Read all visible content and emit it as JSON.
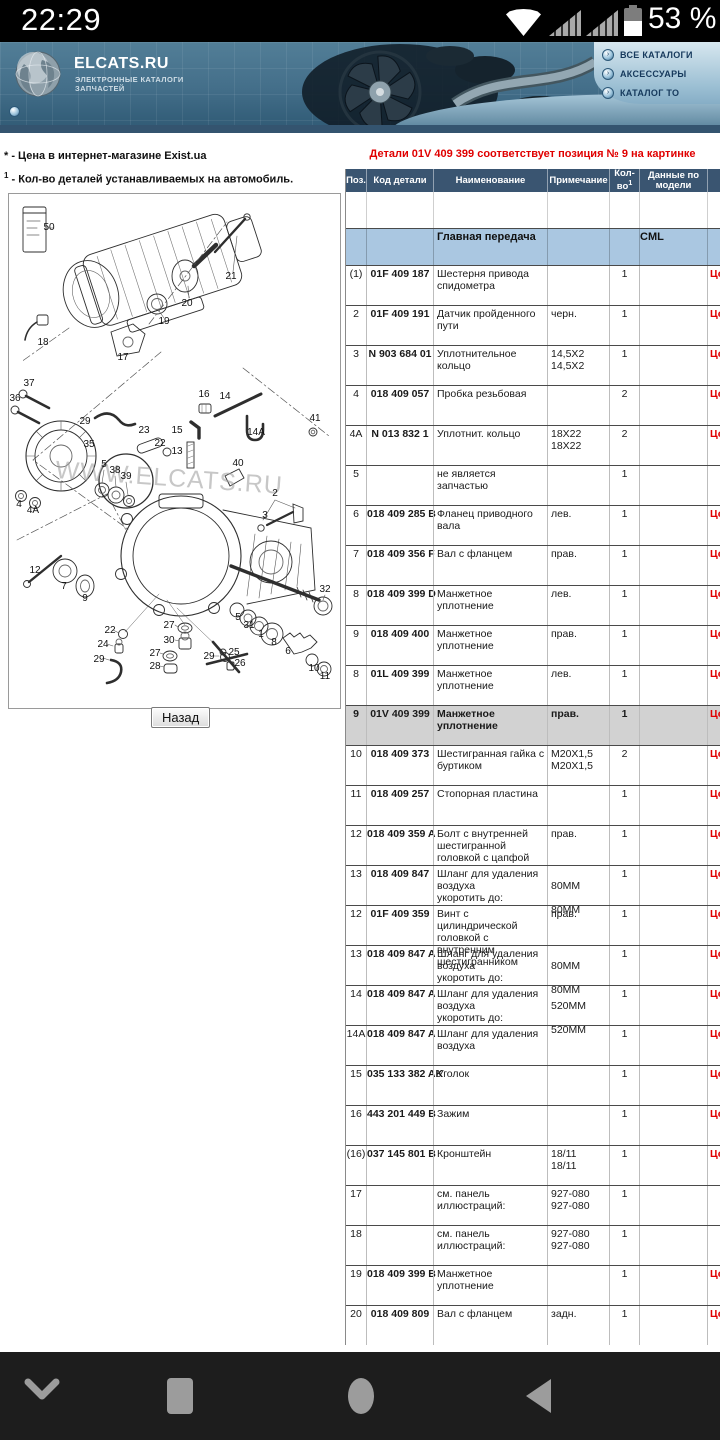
{
  "status_bar": {
    "time": "22:29",
    "battery_pct": "53 %"
  },
  "header": {
    "logo_title": "ELCATS.RU",
    "logo_sub1": "ЭЛЕКТРОННЫЕ КАТАЛОГИ",
    "logo_sub2": "ЗАПЧАСТЕЙ",
    "nav": [
      {
        "label": "ВСЕ КАТАЛОГИ"
      },
      {
        "label": "АКСЕССУАРЫ"
      },
      {
        "label": "КАТАЛОГ ТО"
      }
    ]
  },
  "notes": {
    "price_note": "* - Цена в интернет-магазине Exist.ua",
    "qty_sup": "1",
    "qty_note": " - Кол-во деталей устанавливаемых на автомобиль."
  },
  "alert": "Детали 01V 409 399 соответствует позиция № 9 на картинке",
  "diagram": {
    "back_button": "Назад",
    "watermark": "WWW.ELCATS.RU",
    "callouts": [
      {
        "l": "50",
        "x": 40,
        "y": 36
      },
      {
        "l": "21",
        "x": 222,
        "y": 85
      },
      {
        "l": "20",
        "x": 178,
        "y": 112
      },
      {
        "l": "19",
        "x": 155,
        "y": 130
      },
      {
        "l": "18",
        "x": 34,
        "y": 151
      },
      {
        "l": "17",
        "x": 114,
        "y": 166
      },
      {
        "l": "37",
        "x": 20,
        "y": 192
      },
      {
        "l": "36",
        "x": 6,
        "y": 207
      },
      {
        "l": "29",
        "x": 76,
        "y": 230
      },
      {
        "l": "23",
        "x": 135,
        "y": 239
      },
      {
        "l": "22",
        "x": 151,
        "y": 252
      },
      {
        "l": "16",
        "x": 195,
        "y": 203
      },
      {
        "l": "14",
        "x": 216,
        "y": 205
      },
      {
        "l": "15",
        "x": 168,
        "y": 239
      },
      {
        "l": "13",
        "x": 168,
        "y": 260
      },
      {
        "l": "14A",
        "x": 247,
        "y": 241
      },
      {
        "l": "41",
        "x": 306,
        "y": 227
      },
      {
        "l": "40",
        "x": 229,
        "y": 272
      },
      {
        "l": "2",
        "x": 266,
        "y": 302
      },
      {
        "l": "3",
        "x": 256,
        "y": 324
      },
      {
        "l": "35",
        "x": 80,
        "y": 253
      },
      {
        "l": "5",
        "x": 95,
        "y": 273
      },
      {
        "l": "38",
        "x": 106,
        "y": 279
      },
      {
        "l": "39",
        "x": 117,
        "y": 285
      },
      {
        "l": "4",
        "x": 10,
        "y": 313
      },
      {
        "l": "4A",
        "x": 24,
        "y": 319
      },
      {
        "l": "12",
        "x": 26,
        "y": 379
      },
      {
        "l": "7",
        "x": 55,
        "y": 395
      },
      {
        "l": "9",
        "x": 76,
        "y": 407
      },
      {
        "l": "22",
        "x": 101,
        "y": 439
      },
      {
        "l": "24",
        "x": 94,
        "y": 453
      },
      {
        "l": "29",
        "x": 90,
        "y": 468
      },
      {
        "l": "27",
        "x": 160,
        "y": 434
      },
      {
        "l": "30",
        "x": 160,
        "y": 449
      },
      {
        "l": "27",
        "x": 146,
        "y": 462
      },
      {
        "l": "28",
        "x": 146,
        "y": 475
      },
      {
        "l": "29",
        "x": 200,
        "y": 465
      },
      {
        "l": "25",
        "x": 225,
        "y": 461
      },
      {
        "l": "26",
        "x": 231,
        "y": 472
      },
      {
        "l": "5",
        "x": 229,
        "y": 426
      },
      {
        "l": "31",
        "x": 240,
        "y": 434
      },
      {
        "l": "1",
        "x": 252,
        "y": 443
      },
      {
        "l": "8",
        "x": 265,
        "y": 451
      },
      {
        "l": "6",
        "x": 279,
        "y": 460
      },
      {
        "l": "10",
        "x": 305,
        "y": 477
      },
      {
        "l": "11",
        "x": 316,
        "y": 485
      },
      {
        "l": "32",
        "x": 316,
        "y": 398
      }
    ]
  },
  "table": {
    "headers": [
      "Поз.",
      "Код детали",
      "Наименование",
      "Примечание",
      "Кол-во",
      "Данные по модели",
      "Цена"
    ],
    "qty_sup": "1",
    "group_name": "Главная передача",
    "group_model": "CML",
    "price_label": "Цена",
    "rows": [
      {
        "pos": "(1)",
        "code": "01F 409 187",
        "name": "Шестерня привода спидометра",
        "note": "",
        "qty": "1",
        "price": true
      },
      {
        "pos": "2",
        "code": "01F 409 191",
        "name": "Датчик пройденного пути",
        "note": "черн.",
        "qty": "1",
        "price": true
      },
      {
        "pos": "3",
        "code": "N 903 684 01",
        "name": "Уплотнительное кольцо",
        "note": "14,5X2\n14,5X2",
        "qty": "1",
        "price": true
      },
      {
        "pos": "4",
        "code": "018 409 057",
        "name": "Пробка резьбовая",
        "note": "",
        "qty": "2",
        "price": true
      },
      {
        "pos": "4A",
        "code": "N 013 832 1",
        "name": "Уплотнит. кольцо",
        "note": "18X22\n18X22",
        "qty": "2",
        "price": true
      },
      {
        "pos": "5",
        "code": "",
        "name": "не является запчастью",
        "note": "",
        "qty": "1",
        "price": false
      },
      {
        "pos": "6",
        "code": "018 409 285 B",
        "name": "Фланец приводного вала",
        "note": "лев.",
        "qty": "1",
        "price": true
      },
      {
        "pos": "7",
        "code": "018 409 356 F",
        "name": "Вал с фланцем",
        "note": "прав.",
        "qty": "1",
        "price": true
      },
      {
        "pos": "8",
        "code": "018 409 399 D",
        "name": "Манжетное уплотнение",
        "note": "лев.",
        "qty": "1",
        "price": true
      },
      {
        "pos": "9",
        "code": "018 409 400",
        "name": "Манжетное уплотнение",
        "note": "прав.",
        "qty": "1",
        "price": true
      },
      {
        "pos": "8",
        "code": "01L 409 399",
        "name": "Манжетное уплотнение",
        "note": "лев.",
        "qty": "1",
        "price": true
      },
      {
        "pos": "9",
        "code": "01V 409 399",
        "name": "Манжетное уплотнение",
        "note": "прав.",
        "qty": "1",
        "price": true,
        "highlight": true
      },
      {
        "pos": "10",
        "code": "018 409 373",
        "name": "Шестигранная гайка с буртиком",
        "note": "M20X1,5\nM20X1,5",
        "qty": "2",
        "price": true
      },
      {
        "pos": "11",
        "code": "018 409 257",
        "name": "Стопорная пластина",
        "note": "",
        "qty": "1",
        "price": true
      },
      {
        "pos": "12",
        "code": "018 409 359 A",
        "name": "Болт с внутренней шестигранной головкой с цапфой",
        "note": "прав.",
        "qty": "1",
        "price": true
      },
      {
        "pos": "13",
        "code": "018 409 847",
        "name": "Шланг для удаления воздуха\nукоротить до:",
        "note": "\n80MM\n\n80MM",
        "qty": "1",
        "price": true
      },
      {
        "pos": "12",
        "code": "01F 409 359",
        "name": "Винт с цилиндрической головкой с внутренним шестигранником",
        "note": "прав.",
        "qty": "1",
        "price": true
      },
      {
        "pos": "13",
        "code": "018 409 847 A",
        "name": "Шланг для удаления воздуха\nукоротить до:",
        "note": "\n80MM\n\n80MM",
        "qty": "1",
        "price": true
      },
      {
        "pos": "14",
        "code": "018 409 847 A",
        "name": "Шланг для удаления воздуха\nукоротить до:",
        "note": "\n520MM\n\n520MM",
        "qty": "1",
        "price": true
      },
      {
        "pos": "14A",
        "code": "018 409 847 A",
        "name": "Шланг для удаления воздуха",
        "note": "",
        "qty": "1",
        "price": true
      },
      {
        "pos": "15",
        "code": "035 133 382 AK",
        "name": "Уголок",
        "note": "",
        "qty": "1",
        "price": true
      },
      {
        "pos": "16",
        "code": "443 201 449 B",
        "name": "Зажим",
        "note": "",
        "qty": "1",
        "price": true
      },
      {
        "pos": "(16)",
        "code": "037 145 801 B",
        "name": "Кронштейн",
        "note": "18/11\n18/11",
        "qty": "1",
        "price": true
      },
      {
        "pos": "17",
        "code": "",
        "name": "см. панель иллюстраций:",
        "note": "927-080\n927-080",
        "qty": "1",
        "price": false
      },
      {
        "pos": "18",
        "code": "",
        "name": "см. панель иллюстраций:",
        "note": "927-080\n927-080",
        "qty": "1",
        "price": false
      },
      {
        "pos": "19",
        "code": "018 409 399 B",
        "name": "Манжетное уплотнение",
        "note": "",
        "qty": "1",
        "price": true
      },
      {
        "pos": "20",
        "code": "018 409 809",
        "name": "Вал с фланцем",
        "note": "задн.",
        "qty": "1",
        "price": true
      }
    ]
  },
  "colors": {
    "accent_red": "#e00000",
    "table_header_bg": "#3a5571",
    "group_row_bg": "#aac7e1",
    "highlight_row_bg": "#d2d2d2"
  }
}
